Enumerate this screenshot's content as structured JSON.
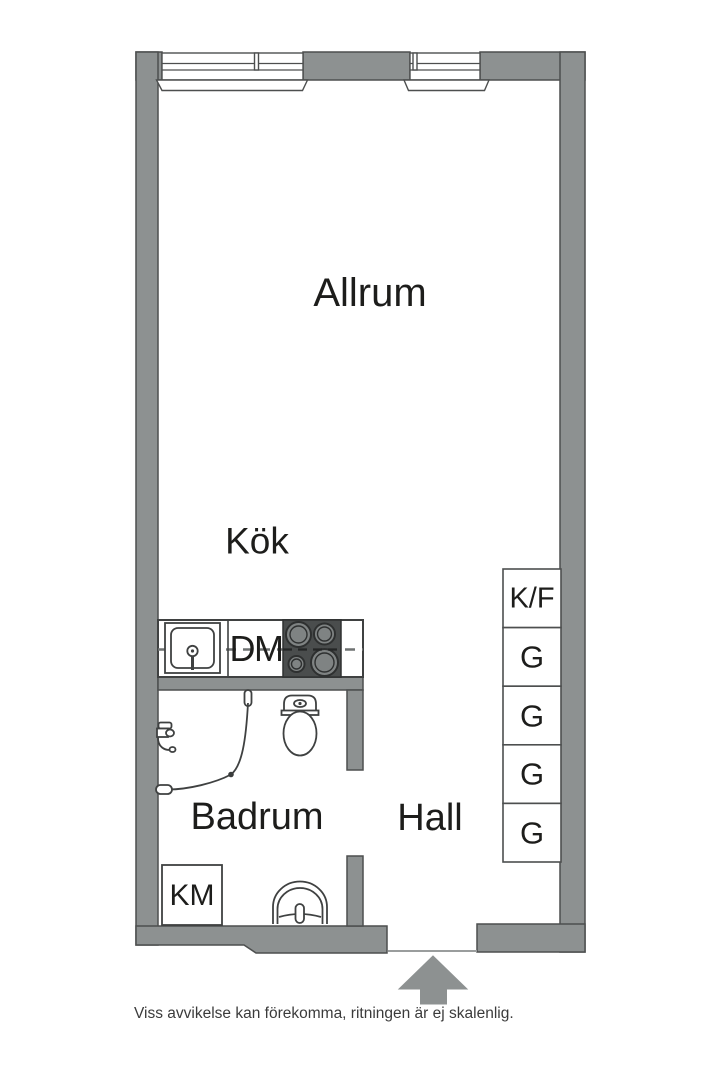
{
  "plan": {
    "rooms": {
      "allrum": "Allrum",
      "kok": "Kök",
      "badrum": "Badrum",
      "hall": "Hall"
    },
    "appliances": {
      "dishwasher": "DM",
      "washing_machine": "KM"
    },
    "closets": {
      "items": [
        "K/F",
        "G",
        "G",
        "G",
        "G"
      ]
    },
    "footer": {
      "disclaimer": "Viss avvikelse kan förekomma, ritningen är ej skalenlig."
    },
    "colors": {
      "wall": "#8d9191",
      "outline": "#4d4f4f",
      "line": "#3f4141",
      "stove": "#4a4d4d",
      "burner": "#7f8383",
      "dash": "#6f7272",
      "text": "#1d1d1b",
      "muted": "#3b3b3b"
    }
  }
}
